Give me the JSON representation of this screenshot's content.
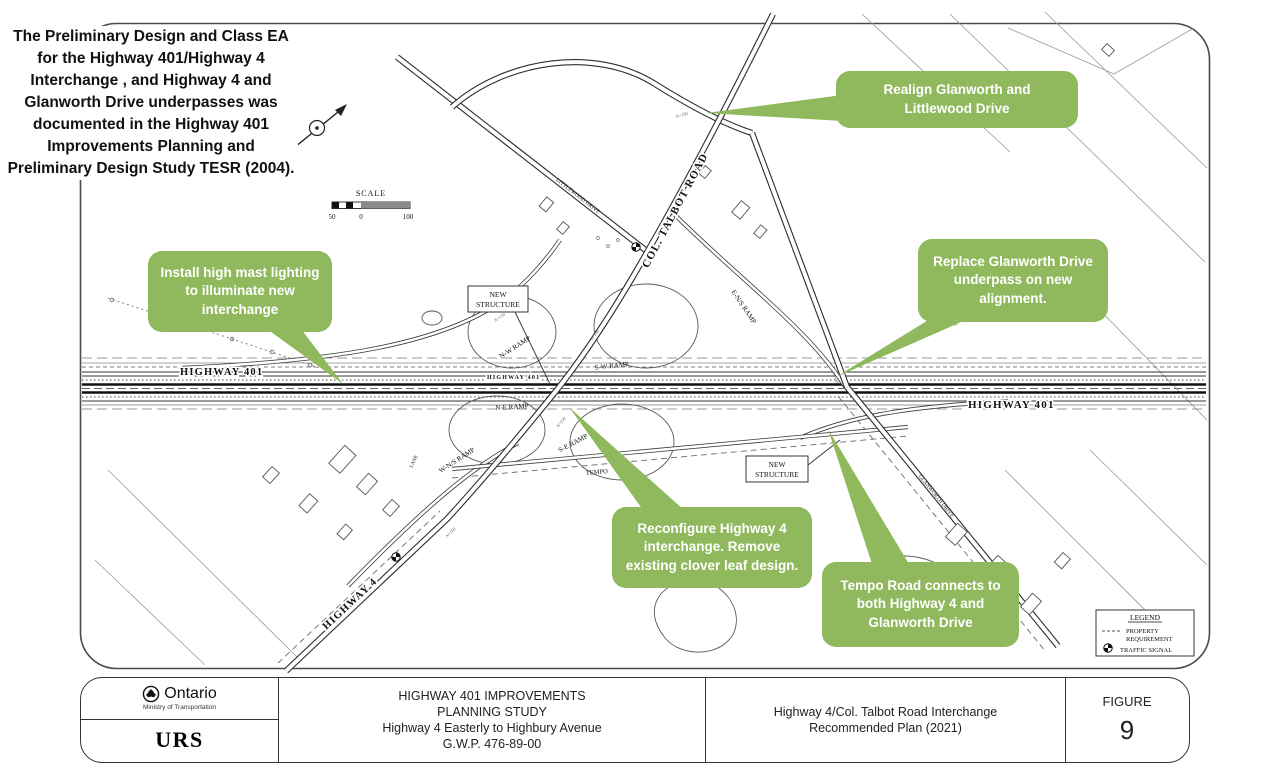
{
  "colors": {
    "callout_green": "#8fb95c",
    "ink": "#1b1b1b"
  },
  "note": {
    "text": "The Preliminary Design and Class EA for the  Highway 401/Highway 4 Interchange , and Highway 4 and Glanworth Drive underpasses was documented in the Highway 401 Improvements Planning and Preliminary Design Study TESR (2004)."
  },
  "callouts": [
    {
      "id": "realign-glanworth",
      "text": "Realign Glanworth and Littlewood Drive"
    },
    {
      "id": "high-mast-lighting",
      "text": "Install high mast lighting to illuminate new interchange"
    },
    {
      "id": "replace-underpass",
      "text": "Replace Glanworth Drive underpass on new alignment."
    },
    {
      "id": "reconfigure-interchange",
      "text": "Reconfigure Highway 4 interchange. Remove existing clover leaf design."
    },
    {
      "id": "tempo-road",
      "text": "Tempo Road connects to both Highway 4 and Glanworth Drive"
    }
  ],
  "map": {
    "labels": {
      "highway401_left": "HIGHWAY 401",
      "highway401_center": "HIGHWAY 401",
      "highway401_right": "HIGHWAY 401",
      "col_talbot_road": "COL. TALBOT ROAD",
      "highway4": "HIGHWAY 4",
      "littlewood_drive": "LITTLEWOOD DRIVE",
      "glanworth_drive": "GLANWORTH DRIVE",
      "tempo": "TEMPO",
      "lane": "LANE",
      "ramp_nw": "N-W RAMP",
      "ramp_sw": "S-W RAMP",
      "ramp_ne": "N-E RAMP",
      "ramp_se": "S-E RAMP",
      "ramp_ens": "E-N/S RAMP",
      "ramp_wns": "W-N/S RAMP",
      "micro": "A=150"
    },
    "new_structure": {
      "line1": "NEW",
      "line2": "STRUCTURE"
    },
    "scale": {
      "title": "SCALE",
      "left": "50",
      "zero": "0",
      "right": "100"
    },
    "legend": {
      "title": "LEGEND",
      "property1": "PROPERTY",
      "property2": "REQUIREMENT",
      "traffic_signal": "TRAFFIC SIGNAL"
    }
  },
  "title_block": {
    "agency": {
      "name": "Ontario",
      "ministry": "Ministry of Transportation"
    },
    "consultant": "URS",
    "project": {
      "line1": "HIGHWAY 401 IMPROVEMENTS",
      "line2": "PLANNING STUDY",
      "line3": "Highway 4 Easterly to Highbury Avenue",
      "line4": "G.W.P. 476-89-00"
    },
    "sheet": {
      "line1": "Highway 4/Col. Talbot Road Interchange",
      "line2": "Recommended Plan (2021)"
    },
    "figure": {
      "label": "FIGURE",
      "number": "9"
    }
  }
}
